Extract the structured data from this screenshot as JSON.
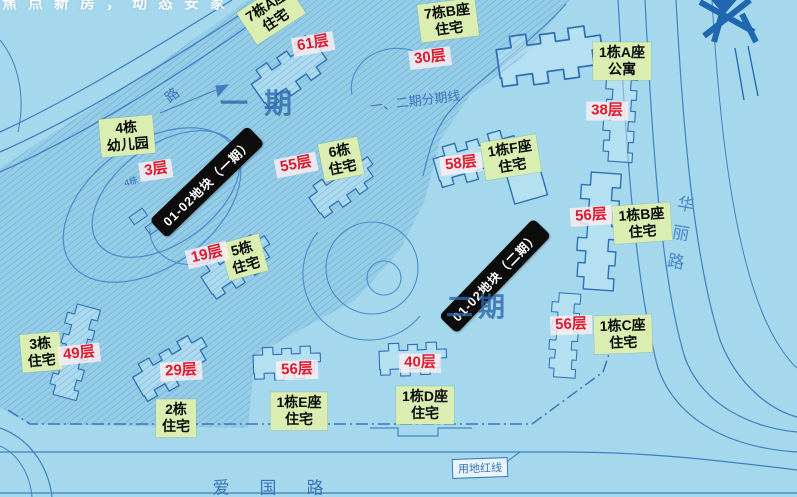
{
  "watermark": "焦点新房，动态安家",
  "banners": [
    {
      "label": "01-02地块（一期）"
    },
    {
      "label": "01-02地块（二期）"
    }
  ],
  "phases": {
    "phase1": "一期",
    "phase2": "二期",
    "divider_label": "一、二期分期线"
  },
  "roads": {
    "top_left_road": "路",
    "right_road": "华丽路",
    "bottom_road": "爱国路",
    "red_line_label": "用地红线",
    "small_marker": "4栋"
  },
  "buildings": [
    {
      "name_line1": "7栋A座",
      "name_line2": "住宅",
      "floors": "61层"
    },
    {
      "name_line1": "7栋B座",
      "name_line2": "住宅",
      "floors": "30层"
    },
    {
      "name_line1": "1栋A座",
      "name_line2": "公寓",
      "floors": "38层"
    },
    {
      "name_line1": "4栋",
      "name_line2": "幼儿园",
      "floors": "3层"
    },
    {
      "name_line1": "6栋",
      "name_line2": "住宅",
      "floors": "55层"
    },
    {
      "name_line1": "1栋F座",
      "name_line2": "住宅",
      "floors": "58层"
    },
    {
      "name_line1": "1栋B座",
      "name_line2": "住宅",
      "floors": "56层"
    },
    {
      "name_line1": "5栋",
      "name_line2": "住宅",
      "floors": "19层"
    },
    {
      "name_line1": "1栋C座",
      "name_line2": "住宅",
      "floors": "56层"
    },
    {
      "name_line1": "3栋",
      "name_line2": "住宅",
      "floors": "49层"
    },
    {
      "name_line1": "2栋",
      "name_line2": "住宅",
      "floors": "29层"
    },
    {
      "name_line1": "1栋E座",
      "name_line2": "住宅",
      "floors": "56层"
    },
    {
      "name_line1": "1栋D座",
      "name_line2": "住宅",
      "floors": "40层"
    }
  ],
  "colors": {
    "background": "#a5d8ec",
    "map_line": "#3f7fc2",
    "label_background": "#d9eeb0",
    "floor_red": "#e21a2e",
    "banner_background": "#0c0c0c",
    "phase_text_blue": "#2c66aa"
  }
}
